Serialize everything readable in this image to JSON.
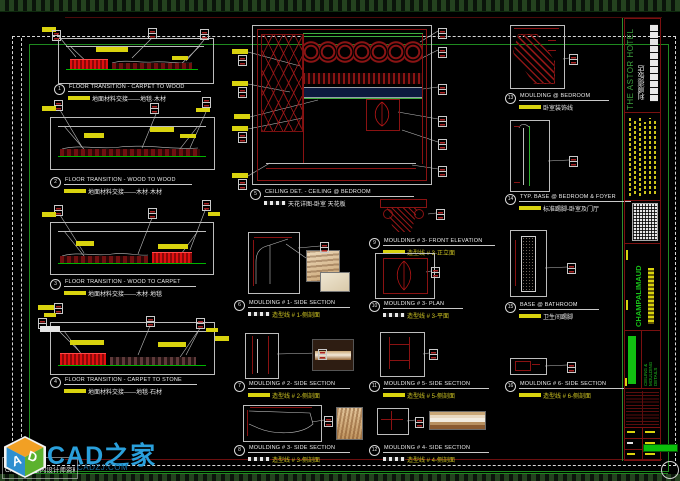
{
  "details": [
    {
      "num": "1",
      "title": "FLOOR TRANSITION - CARPET TO WOOD",
      "sub": "地面材料交接——地毯·木材"
    },
    {
      "num": "2",
      "title": "FLOOR TRANSITION - WOOD TO WOOD",
      "sub": "地面材料交接——木材·木材"
    },
    {
      "num": "3",
      "title": "FLOOR TRANSITION - WOOD TO CARPET",
      "sub": "地面材料交接——木材·地毯"
    },
    {
      "num": "4",
      "title": "FLOOR TRANSITION - CARPET TO STONE",
      "sub": "地面材料交接——地毯·石材"
    },
    {
      "num": "5",
      "title": "CEILING DET. - CEILING @ BEDROOM",
      "sub": "天花详图-卧室 天花板"
    },
    {
      "num": "6",
      "title": "MOULDING # 1- SIDE SECTION",
      "sub": "造型线 # 1-侧剖面"
    },
    {
      "num": "7",
      "title": "MOULDING # 2- SIDE SECTION",
      "sub": "造型线 # 2-侧剖面"
    },
    {
      "num": "8",
      "title": "MOULDING # 3- SIDE SECTION",
      "sub": "造型线 # 3-侧剖面"
    },
    {
      "num": "9",
      "title": "MOULDING # 3- FRONT ELEVATION",
      "sub": "造型线 # 3-正立面"
    },
    {
      "num": "10",
      "title": "MOULDING # 3- PLAN",
      "sub": "造型线 # 3-平面"
    },
    {
      "num": "11",
      "title": "MOULDING # 5- SIDE SECTION",
      "sub": "造型线 # 5-侧剖面"
    },
    {
      "num": "12",
      "title": "MOULDING # 4- SIDE SECTION",
      "sub": "造型线 # 4-侧剖面"
    },
    {
      "num": "13",
      "title": "MOULDING @ BEDROOM",
      "sub": "卧室装饰线"
    },
    {
      "num": "14",
      "title": "TYP. BASE @ BEDROOM & FOYER",
      "sub": "标准踢脚-卧室及门厅"
    },
    {
      "num": "15",
      "title": "BASE @ BATHROOM",
      "sub": "卫生间踢脚"
    },
    {
      "num": "16",
      "title": "MOULDING # 6- SIDE SECTION",
      "sub": "造型线 # 6-侧剖面"
    }
  ],
  "titleblock": {
    "project_en": "THE ASTOR HOTEL",
    "project_cn": "利顺德饭店",
    "firm": "CHAMPALIMAUD",
    "sheet_title_lines": [
      "CEILING &",
      "MOULDING",
      "DETAILS"
    ]
  },
  "watermark": {
    "brand": "CAD之家",
    "url": "CADZJ.COM",
    "caption": "CAD之家|室内设计师资料库",
    "cube_left_letter": "A",
    "cube_right_letter": "D"
  },
  "colors": {
    "accent_yellow": "#d9d30e",
    "cad_red": "#8a1212",
    "cad_green": "#00b400",
    "border_green": "#1f8a1f",
    "brand_blue": "#2aa0dc"
  }
}
